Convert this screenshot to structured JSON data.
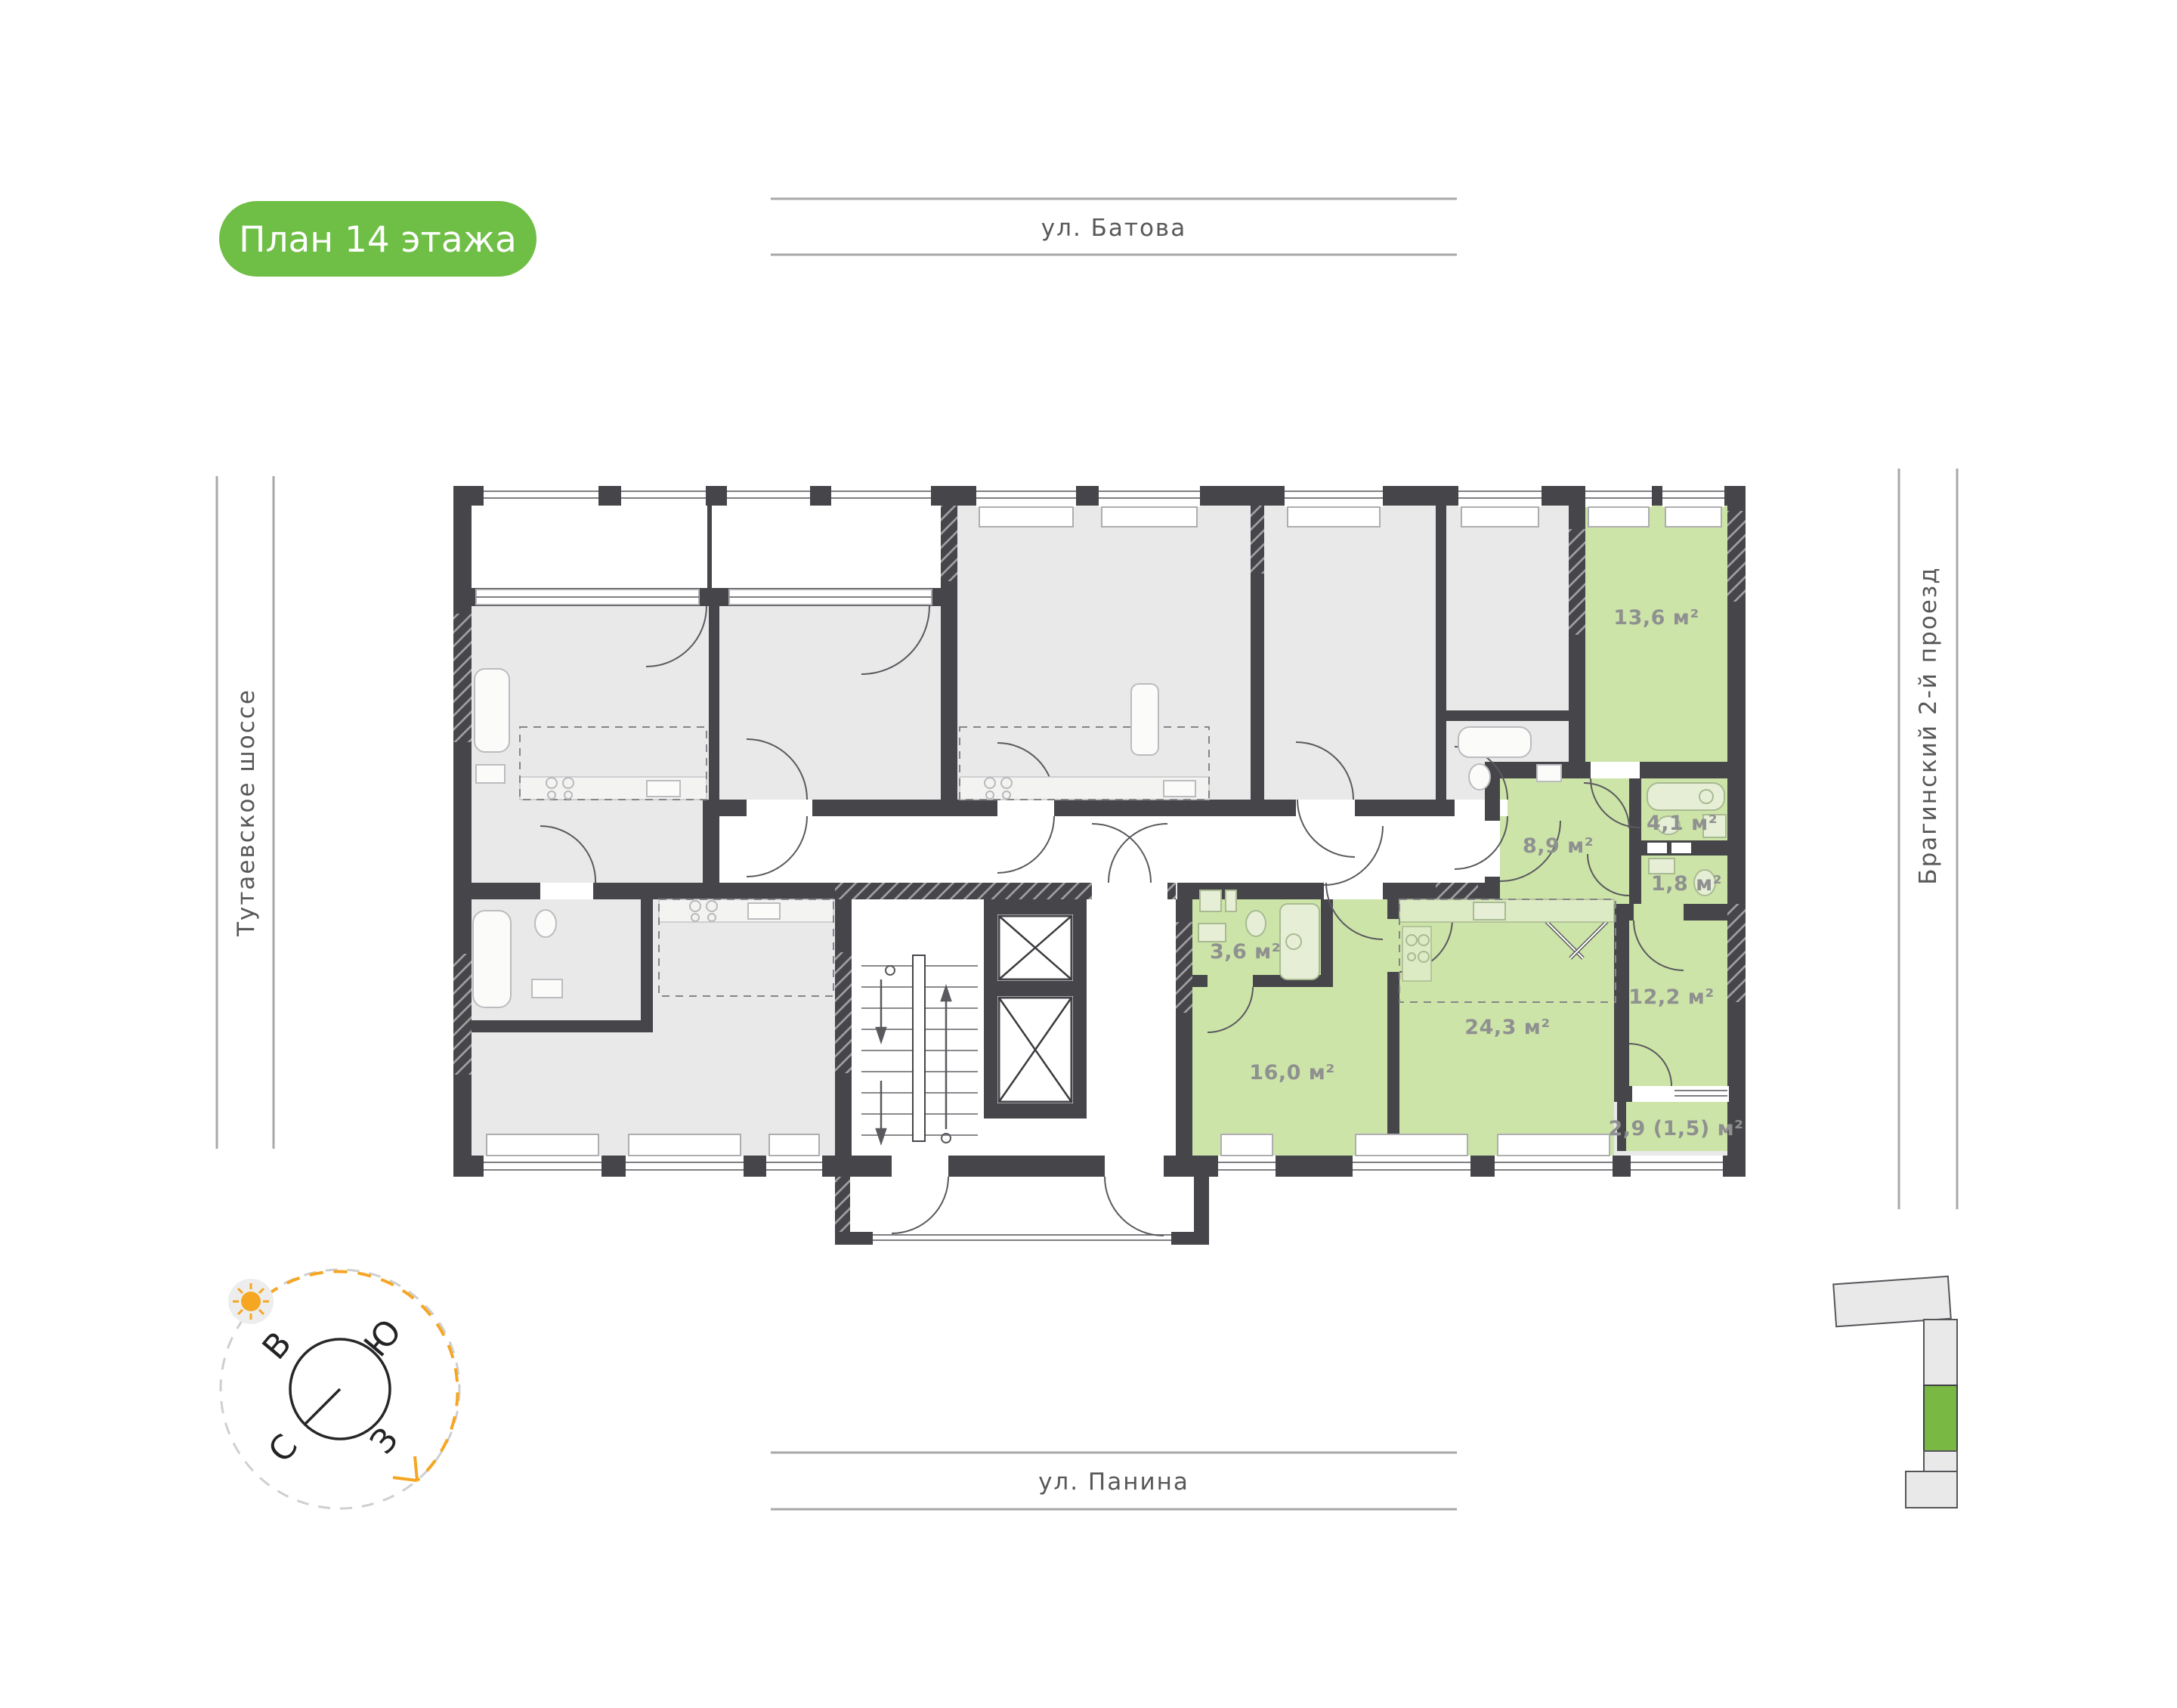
{
  "badge": {
    "label": "План 14 этажа",
    "bg_color": "#6fbe45"
  },
  "streets": {
    "top": "ул. Батова",
    "bottom": "ул. Панина",
    "left": "Тутаевское шоссе",
    "right": "Брагинский 2-й проезд"
  },
  "compass": {
    "north": "С",
    "south": "Ю",
    "east": "В",
    "west": "З",
    "sun_color": "#f5a623"
  },
  "plan": {
    "highlighted_rooms": [
      {
        "id": "room-13-6",
        "area": "13,6 м²"
      },
      {
        "id": "bath-4-1",
        "area": "4,1 м²"
      },
      {
        "id": "hall-8-9",
        "area": "8,9 м²"
      },
      {
        "id": "wc-1-8",
        "area": "1,8 м²"
      },
      {
        "id": "room-12-2",
        "area": "12,2 м²"
      },
      {
        "id": "balcony-2-9",
        "area": "2,9 (1,5) м²"
      },
      {
        "id": "bath-3-6",
        "area": "3,6 м²"
      },
      {
        "id": "room-16-0",
        "area": "16,0 м²"
      },
      {
        "id": "kitchen-living-24-3",
        "area": "24,3 м²"
      }
    ],
    "colors": {
      "highlight_fill": "#cde4a8",
      "wall": "#46464a",
      "other_room_fill": "#e9e9ea",
      "area_label": "#8f9190"
    }
  },
  "site_plan": {
    "highlight_color": "#78b843"
  }
}
